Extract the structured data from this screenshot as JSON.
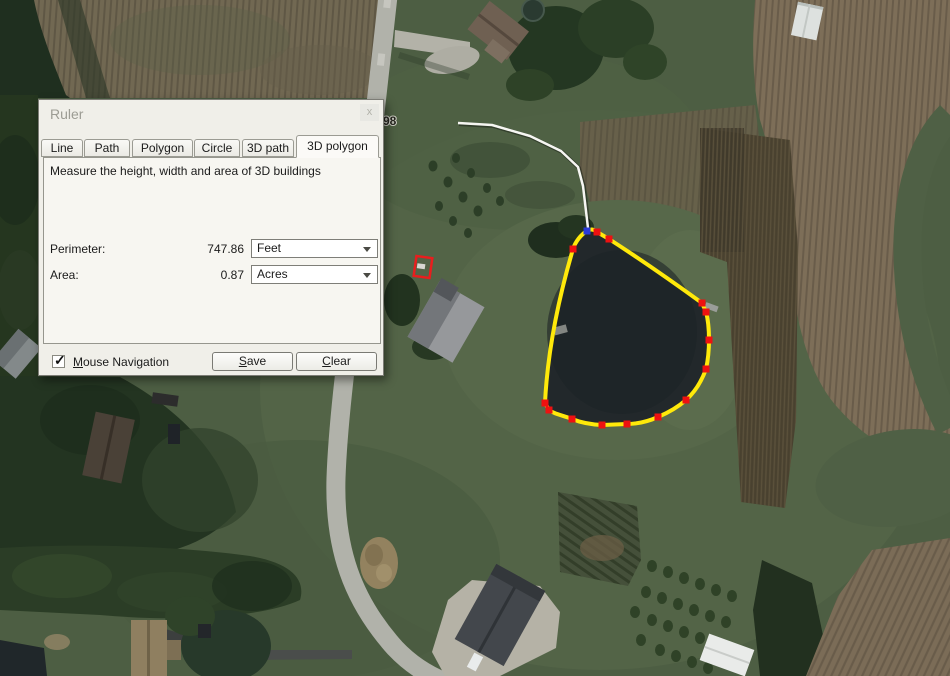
{
  "dialog": {
    "title": "Ruler",
    "close_glyph": "x",
    "tabs": [
      {
        "label": "Line"
      },
      {
        "label": "Path"
      },
      {
        "label": "Polygon"
      },
      {
        "label": "Circle"
      },
      {
        "label": "3D path"
      },
      {
        "label": "3D polygon",
        "active": true
      }
    ],
    "description": "Measure the height, width and area of 3D buildings",
    "perimeter": {
      "label": "Perimeter:",
      "value": "747.86",
      "unit": "Feet"
    },
    "area": {
      "label": "Area:",
      "value": "0.87",
      "unit": "Acres"
    },
    "mouse_navigation": {
      "label": "Mouse Navigation",
      "checked": true,
      "check_glyph": "✓"
    },
    "buttons": {
      "save": "Save",
      "clear": "Clear"
    }
  },
  "map": {
    "road_label": "98",
    "overlay": {
      "polygon_color": "#ffe90a",
      "vertex_color": "#ee1111",
      "start_vertex_color": "#2a3bd8",
      "marker_color": "#e81e1e",
      "line_color": "#f6f6f2"
    }
  }
}
